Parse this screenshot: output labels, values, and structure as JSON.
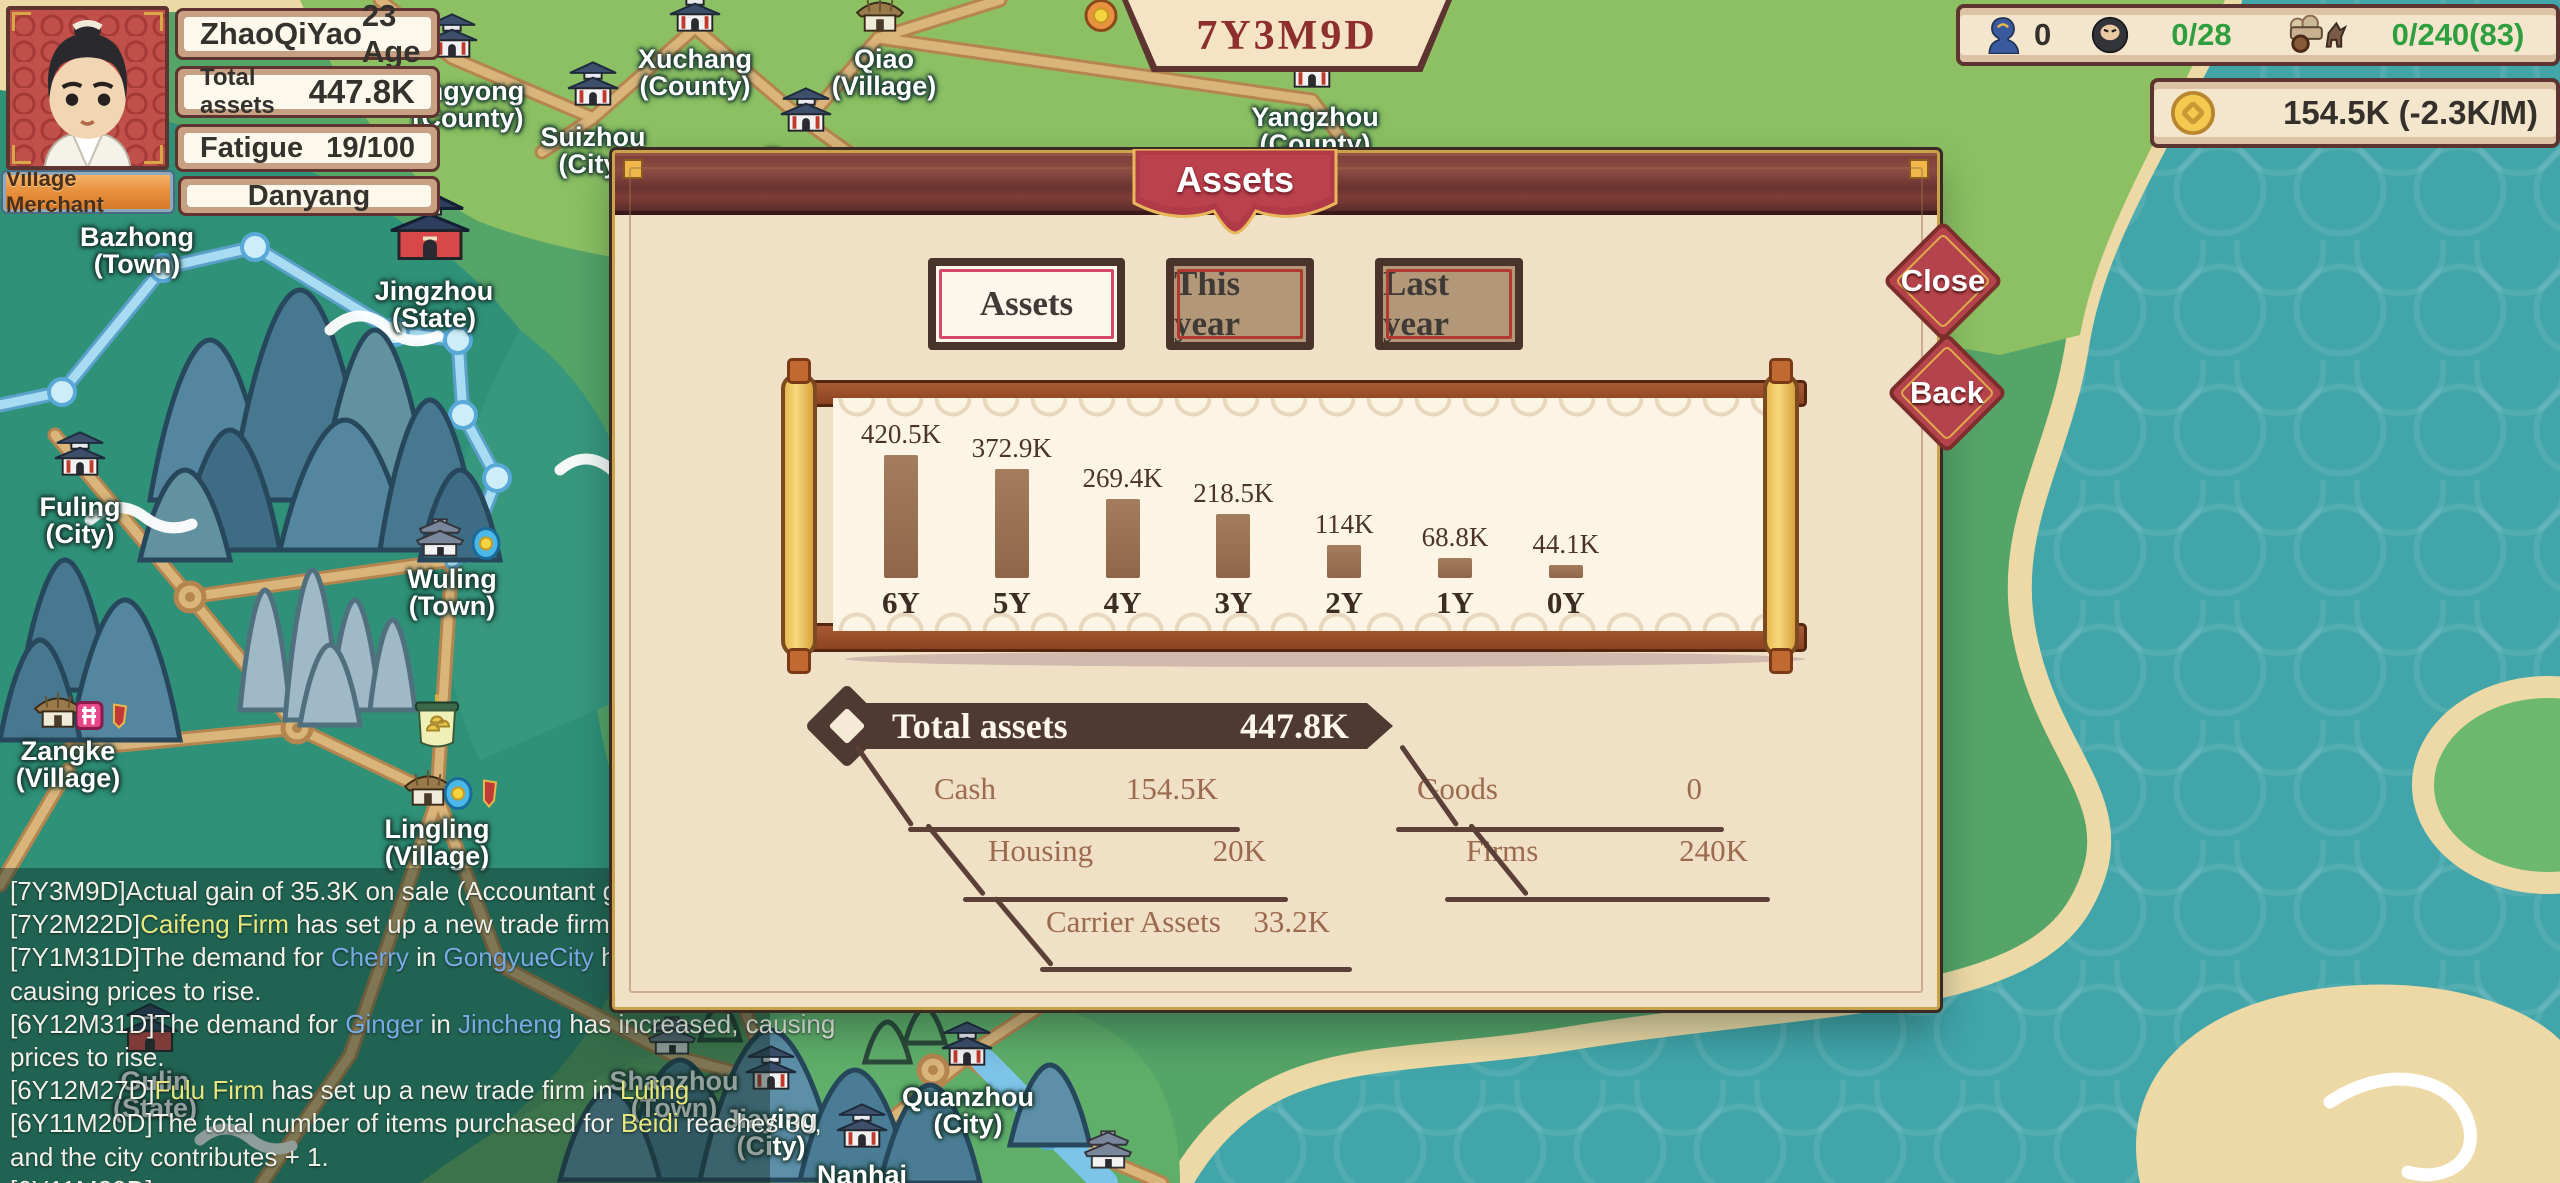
{
  "player": {
    "name": "ZhaoQiYao",
    "age": "23 Age",
    "role": "Village Merchant",
    "location": "Danyang",
    "assets_label": "Total assets",
    "assets_value": "447.8K",
    "fatigue_label": "Fatigue",
    "fatigue_value": "19/100"
  },
  "date": "7Y3M9D",
  "resources": {
    "apprentice_count": "0",
    "crew_count": "0/28",
    "carrier_count": "0/240(83)",
    "money": "154.5K (-2.3K/M)"
  },
  "modal": {
    "title": "Assets",
    "tabs": [
      {
        "label": "Assets",
        "active": true
      },
      {
        "label": "This year",
        "active": false
      },
      {
        "label": "Last year",
        "active": false
      }
    ],
    "close": "Close",
    "back": "Back",
    "total": {
      "label": "Total assets",
      "value": "447.8K"
    },
    "breakdown": [
      {
        "label": "Cash",
        "value": "154.5K"
      },
      {
        "label": "Goods",
        "value": "0"
      },
      {
        "label": "Housing",
        "value": "20K"
      },
      {
        "label": "Firms",
        "value": "240K"
      },
      {
        "label": "Carrier Assets",
        "value": "33.2K"
      }
    ]
  },
  "chart_data": {
    "type": "bar",
    "categories": [
      "6Y",
      "5Y",
      "4Y",
      "3Y",
      "2Y",
      "1Y",
      "0Y"
    ],
    "values": [
      420500,
      372900,
      269400,
      218500,
      114000,
      68800,
      44100
    ],
    "value_labels": [
      "420.5K",
      "372.9K",
      "269.4K",
      "218.5K",
      "114K",
      "68.8K",
      "44.1K"
    ],
    "title": "Assets",
    "xlabel": "",
    "ylabel": "",
    "ylim": [
      0,
      420500
    ],
    "bar_color": "#97704f",
    "grid": false,
    "legend": "none"
  },
  "colors": {
    "highlight_yellow": "#e7e77d",
    "highlight_blue": "#78abe4",
    "log_white": "#f1f0e9",
    "counter_green": "#2f9e3f",
    "banner_red": "#b03a48",
    "diamond_red": "#b4434b"
  },
  "log": {
    "lines": [
      [
        {
          "t": "[7Y3M9D]Actual gain of 35.3K on sale (Accountant gained 62",
          "c": "w"
        }
      ],
      [
        {
          "t": "[7Y2M22D]",
          "c": "w"
        },
        {
          "t": "Caifeng Firm",
          "c": "y"
        },
        {
          "t": " has set up a new trade firm in ",
          "c": "w"
        },
        {
          "t": "Bazhong",
          "c": "y"
        }
      ],
      [
        {
          "t": "[7Y1M31D]The demand for ",
          "c": "w"
        },
        {
          "t": "Cherry",
          "c": "b"
        },
        {
          "t": " in ",
          "c": "w"
        },
        {
          "t": "GongyueCity",
          "c": "b"
        },
        {
          "t": " has increased,",
          "c": "w"
        }
      ],
      [
        {
          "t": "causing prices to rise.",
          "c": "w"
        }
      ],
      [
        {
          "t": "[6Y12M31D]The demand for ",
          "c": "w"
        },
        {
          "t": "Ginger",
          "c": "b"
        },
        {
          "t": " in ",
          "c": "w"
        },
        {
          "t": "Jincheng",
          "c": "b"
        },
        {
          "t": " has increased, causing",
          "c": "w"
        }
      ],
      [
        {
          "t": "prices to rise.",
          "c": "w"
        }
      ],
      [
        {
          "t": "[6Y12M27D]",
          "c": "w"
        },
        {
          "t": "Fulu Firm",
          "c": "y"
        },
        {
          "t": " has set up a new trade firm in ",
          "c": "w"
        },
        {
          "t": "Luling",
          "c": "y"
        }
      ],
      [
        {
          "t": "[6Y11M20D]The total number of items purchased for ",
          "c": "w"
        },
        {
          "t": "Beidi",
          "c": "y"
        },
        {
          "t": " reaches 30,",
          "c": "w"
        }
      ],
      [
        {
          "t": "and the city contributes + 1.",
          "c": "w"
        }
      ],
      [
        {
          "t": "[6Y11M20D]",
          "c": "w"
        }
      ]
    ]
  },
  "map": {
    "cities": [
      {
        "name": "angyong",
        "sub": "(County)",
        "x": 468,
        "y": 78,
        "icon": "pagoda",
        "ix": 452,
        "iy": 38
      },
      {
        "name": "Xuchang",
        "sub": "(County)",
        "x": 695,
        "y": 46,
        "icon": "pagoda",
        "ix": 695,
        "iy": 12
      },
      {
        "name": "Qiao",
        "sub": "(Village)",
        "x": 884,
        "y": 46,
        "icon": "hut",
        "ix": 880,
        "iy": 16
      },
      {
        "name": "Yangzhou",
        "sub": "(County)",
        "x": 1315,
        "y": 104,
        "icon": "pagoda",
        "ix": 1312,
        "iy": 68
      },
      {
        "name": "Runan",
        "sub": "",
        "x": 806,
        "y": 146,
        "icon": "pagoda",
        "ix": 806,
        "iy": 112
      },
      {
        "name": "Suizhou",
        "sub": "(City)",
        "x": 593,
        "y": 124,
        "icon": "pagoda",
        "ix": 593,
        "iy": 86
      },
      {
        "name": "Bazhong",
        "sub": "(Town)",
        "x": 137,
        "y": 224,
        "icon": "none",
        "ix": 0,
        "iy": 0
      },
      {
        "name": "Jingzhou",
        "sub": "(State)",
        "x": 434,
        "y": 278,
        "icon": "pagoda_red",
        "ix": 430,
        "iy": 228
      },
      {
        "name": "Fuling",
        "sub": "(City)",
        "x": 80,
        "y": 494,
        "icon": "pagoda",
        "ix": 80,
        "iy": 456
      },
      {
        "name": "Wuling",
        "sub": "(Town)",
        "x": 452,
        "y": 566,
        "icon": "house",
        "ix": 440,
        "iy": 540,
        "badge": "coin"
      },
      {
        "name": "Zangke",
        "sub": "(Village)",
        "x": 68,
        "y": 738,
        "icon": "hut",
        "ix": 58,
        "iy": 712,
        "badge": "emblem"
      },
      {
        "name": "Lingling",
        "sub": "(Village)",
        "x": 437,
        "y": 816,
        "icon": "hut",
        "ix": 428,
        "iy": 790,
        "badge": "coinflag",
        "extra": "banner"
      },
      {
        "name": "Gulin",
        "sub": "(State)",
        "x": 155,
        "y": 1068,
        "icon": "pagoda_red_s",
        "ix": 150,
        "iy": 1030
      },
      {
        "name": "Shaozhou",
        "sub": "(Town)",
        "x": 674,
        "y": 1068,
        "icon": "house",
        "ix": 672,
        "iy": 1038
      },
      {
        "name": "Jiaying",
        "sub": "(City)",
        "x": 771,
        "y": 1106,
        "icon": "pagoda",
        "ix": 771,
        "iy": 1070
      },
      {
        "name": "Nanhai",
        "sub": "",
        "x": 862,
        "y": 1162,
        "icon": "pagoda",
        "ix": 862,
        "iy": 1128
      },
      {
        "name": "Quanzhou",
        "sub": "(City)",
        "x": 968,
        "y": 1084,
        "icon": "pagoda",
        "ix": 967,
        "iy": 1046
      },
      {
        "name": "",
        "sub": "",
        "x": 1110,
        "y": 1180,
        "icon": "house",
        "ix": 1108,
        "iy": 1152
      }
    ]
  }
}
